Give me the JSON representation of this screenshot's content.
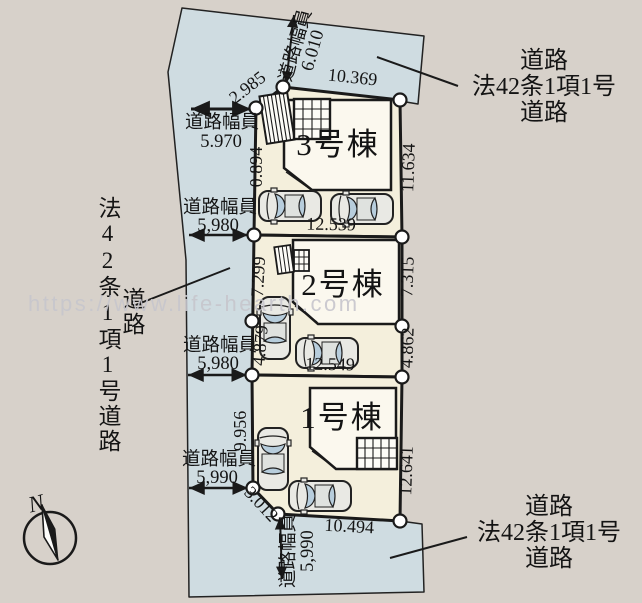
{
  "plan": {
    "building_labels": {
      "b1": "1号棟",
      "b2": "2号棟",
      "b3": "3号棟"
    },
    "road_width_caption": "道路幅員",
    "road_widths": {
      "top": "6.010",
      "left_1": "5.970",
      "left_2": "5,980",
      "left_3": "5,980",
      "left_4": "5,990",
      "bottom": "5,990"
    },
    "dimensions": {
      "top_corner_cut": "2.985",
      "lot3_top": "10.369",
      "lot3_left": "0.894",
      "lot3_right": "11.634",
      "lot3_bottom": "12.539",
      "lot2_left_upper": "7.299",
      "lot2_right_upper": "7.315",
      "lot2_left_lower": "4.879",
      "lot2_right_lower": "4.862",
      "lot2_bottom": "12.549",
      "lot1_left": "9.956",
      "lot1_right": "12.641",
      "lot1_bottom": "10.494",
      "bottom_corner_cut": "3.012"
    }
  },
  "side_labels": {
    "left_vertical": "法42条1項1号道路",
    "left_road": "道路",
    "top_right": [
      "道路",
      "法42条1項1号",
      "道路"
    ],
    "bottom_right": [
      "道路",
      "法42条1項1号",
      "道路"
    ]
  },
  "compass": {
    "north": "N"
  },
  "watermark": "https://www.life-hearth.com",
  "colors": {
    "background": "#d7d1ca",
    "road": "#cfdce1",
    "lot": "#f4efdc",
    "building": "#fbf8ee",
    "line": "#1a1a1a"
  }
}
